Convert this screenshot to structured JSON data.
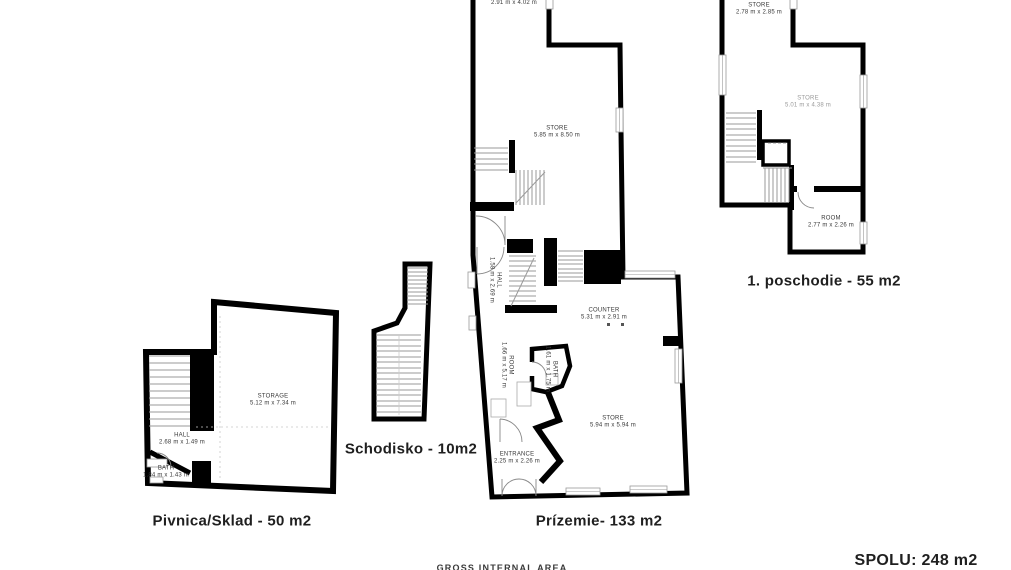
{
  "plans": {
    "pivnica": {
      "title": "Pivnica/Sklad - 50 m2",
      "rooms": {
        "storage": {
          "name": "STORAGE",
          "dims": "5.12 m x 7.34 m"
        },
        "hall": {
          "name": "HALL",
          "dims": "2.68 m x 1.49 m"
        },
        "bath": {
          "name": "BATH",
          "dims": "1.84 m x 1.43 m"
        }
      }
    },
    "schodisko": {
      "title": "Schodisko - 10m2"
    },
    "prizemie": {
      "title": "Prízemie- 133 m2",
      "rooms": {
        "top_room": {
          "dims": "2.91 m x 4.02 m"
        },
        "store_upper": {
          "name": "STORE",
          "dims": "5.85 m x 8.50 m"
        },
        "hall": {
          "name": "HALL",
          "dims": "1.58 m x 2.69 m"
        },
        "counter": {
          "name": "COUNTER",
          "dims": "5.31 m x 2.91 m"
        },
        "room": {
          "name": "ROOM",
          "dims": "1.66 m x 5.17 m"
        },
        "bath": {
          "name": "BATH",
          "dims": "1.61 m x 1.75 m"
        },
        "store_lower": {
          "name": "STORE",
          "dims": "5.94 m x 5.94 m"
        },
        "entrance": {
          "name": "ENTRANCE",
          "dims": "2.25 m x 2.26 m"
        }
      }
    },
    "poschodie": {
      "title": "1. poschodie - 55 m2",
      "rooms": {
        "store_small": {
          "name": "STORE",
          "dims": "2.78 m x 2.85 m"
        },
        "store_main": {
          "name": "STORE",
          "dims": "5.01 m x 4.38 m"
        },
        "room": {
          "name": "ROOM",
          "dims": "2.77 m x 2.26 m"
        }
      }
    }
  },
  "footer": {
    "gross_area_label": "GROSS INTERNAL AREA",
    "total": "SPOLU: 248 m2"
  },
  "colors": {
    "wall": "#000000",
    "stair_tread": "#9a9a9a",
    "label_text": "#3a3a3a",
    "faint_label_text": "#9a9a9a"
  }
}
